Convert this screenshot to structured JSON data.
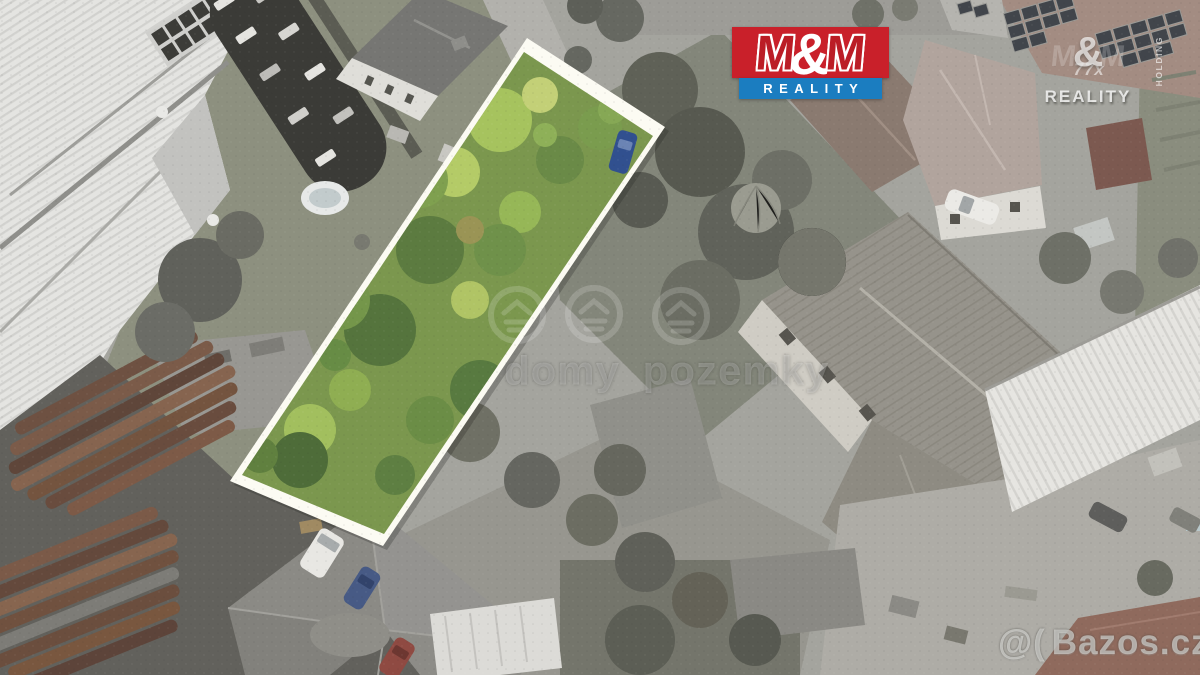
{
  "branding": {
    "mm_logo": {
      "m_left": "M",
      "ampersand": "&",
      "m_right": "M",
      "banner": "REALITY",
      "red": "#c9202a",
      "blue": "#1b7dc0"
    },
    "mm_watermark": {
      "m_left": "M",
      "ampersand": "&",
      "m_right": "M",
      "sub": "77x",
      "reality": "REALITY",
      "holding": "HOLDING"
    }
  },
  "watermarks": {
    "center_text": "domy pozemky",
    "bazos_symbol": "@(",
    "bazos_site": "Bazos.cz"
  },
  "highlight": {
    "plot_border_color": "#fcfbf3",
    "plot_green": "#7b974e"
  }
}
